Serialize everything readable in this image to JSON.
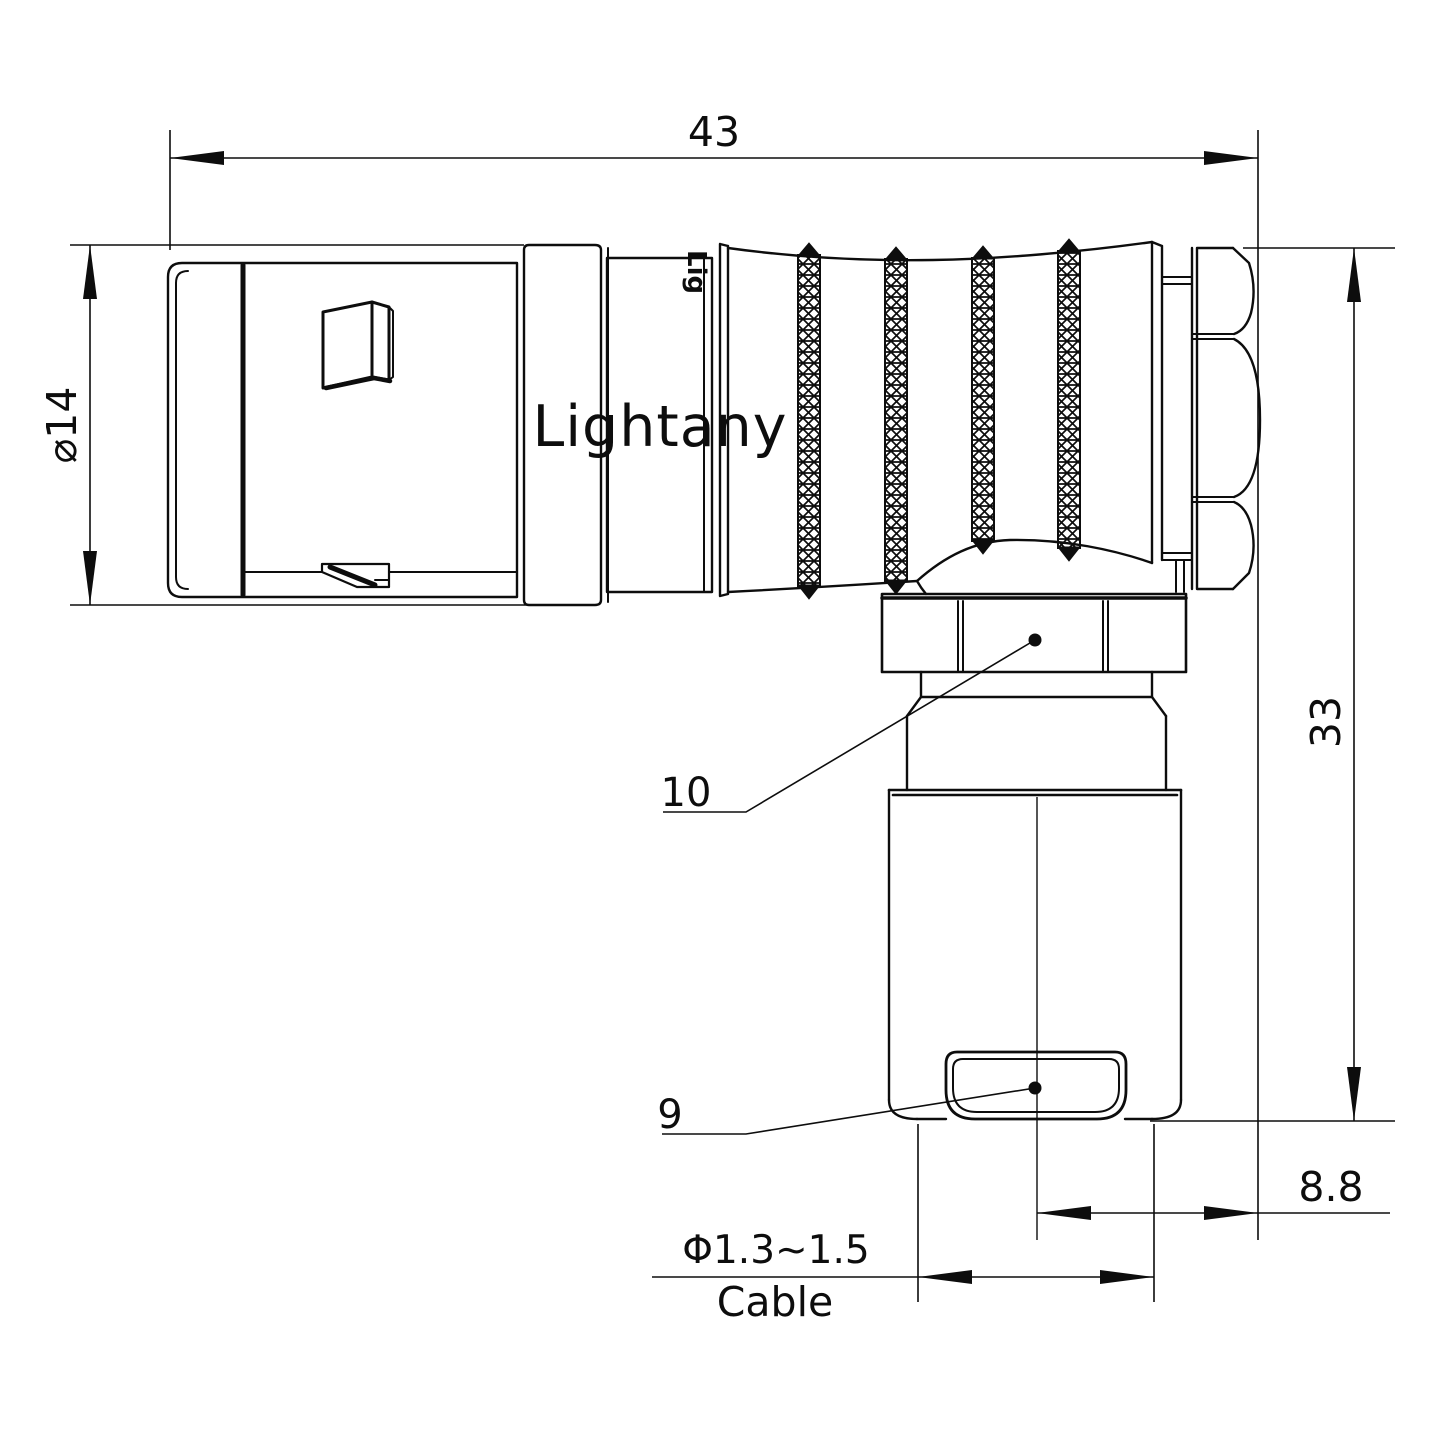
{
  "drawing": {
    "title": "right-angle connector technical drawing",
    "watermark": "Lightany",
    "engraving": "Lig",
    "dimensions": {
      "overall_length": "43",
      "front_diameter": "⌀14",
      "overall_height": "33",
      "rear_offset": "8.8",
      "cable_diameter": "Φ1.3~1.5",
      "cable_label": "Cable"
    },
    "part_labels": {
      "coupling_nut": "10",
      "cable_clamp": "9"
    },
    "colors": {
      "line": "#0d0d0d",
      "watermark_pink": "#f6c6c6",
      "background": "#ffffff"
    }
  }
}
